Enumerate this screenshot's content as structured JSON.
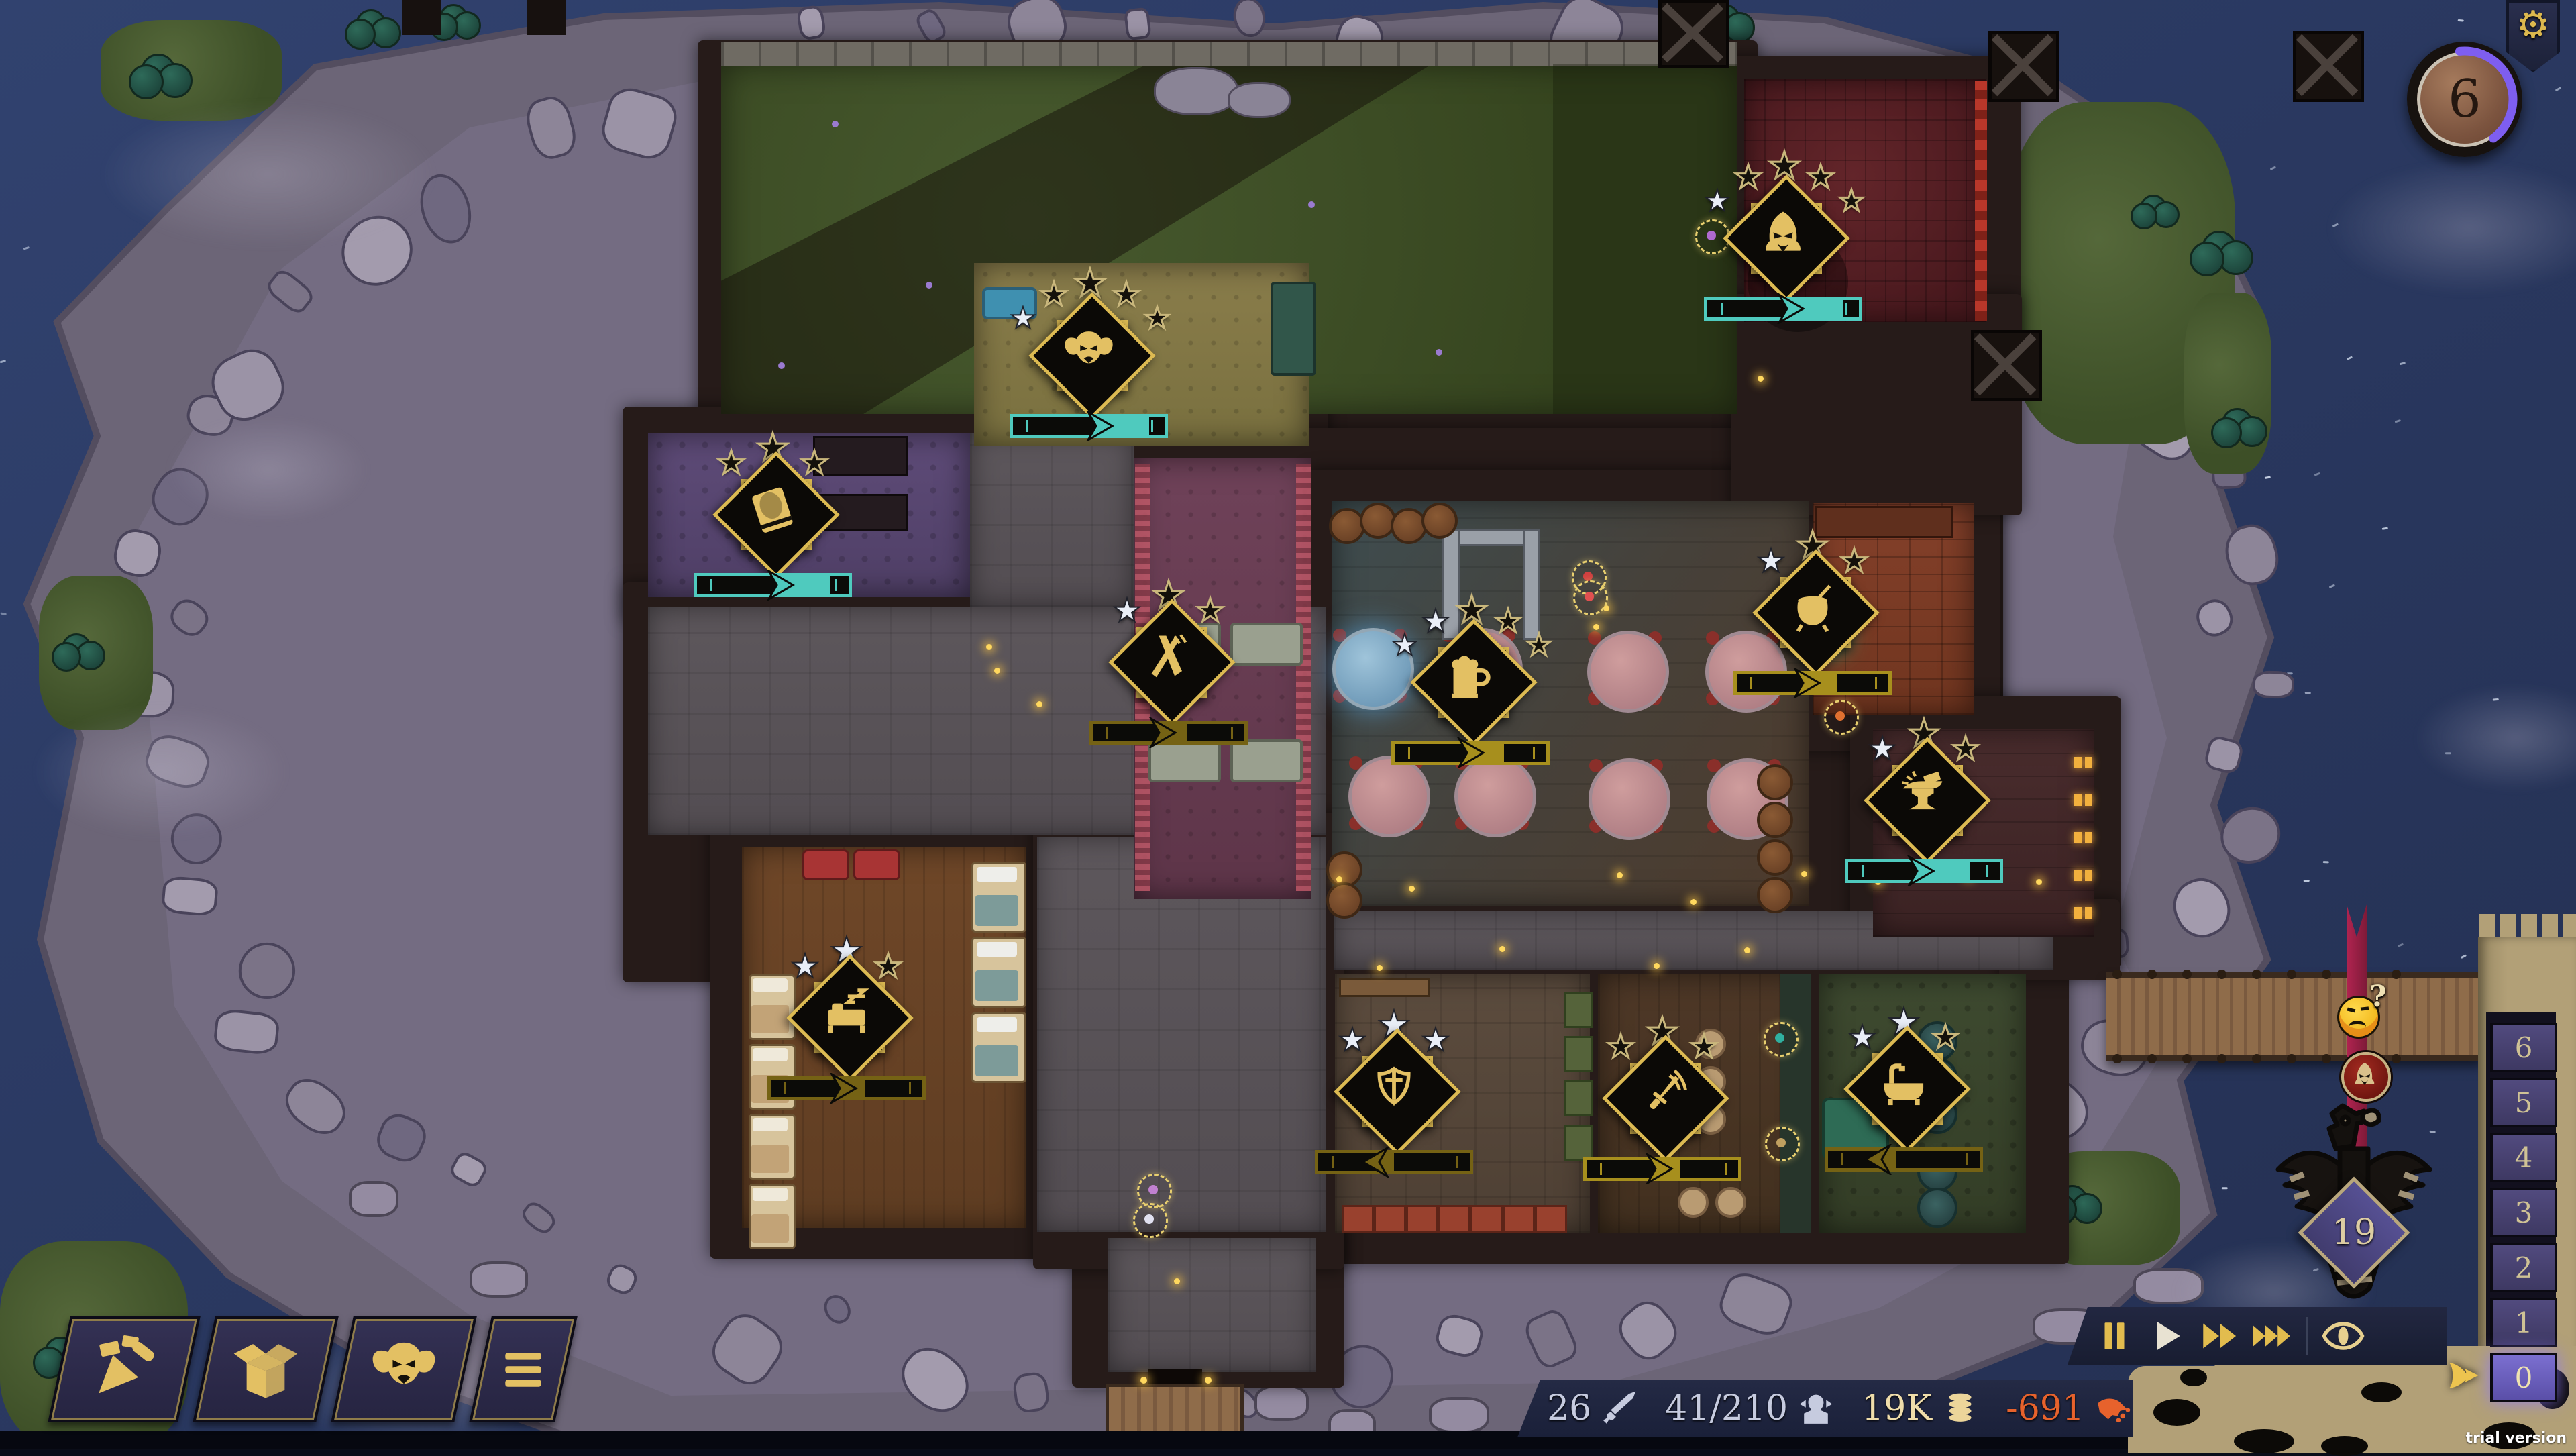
{
  "meta": {
    "trial_label": "trial version"
  },
  "top_right": {
    "settings_gear": "⚙",
    "clock_value": "6",
    "clock_progress_deg": 150
  },
  "toolbar": {
    "buttons": [
      {
        "id": "build",
        "icon": "trowel-icon"
      },
      {
        "id": "storage",
        "icon": "box-icon"
      },
      {
        "id": "staff",
        "icon": "goblin-icon"
      },
      {
        "id": "menu",
        "icon": "menu-icon"
      }
    ]
  },
  "speed_bar": {
    "buttons": [
      {
        "id": "pause",
        "icon": "pause-icon",
        "color": "#e2bc4e"
      },
      {
        "id": "play",
        "icon": "play-icon",
        "color": "#e8e2d2"
      },
      {
        "id": "speed2",
        "icon": "ff2-icon",
        "color": "#e2bc4e"
      },
      {
        "id": "speed3",
        "icon": "ff3-icon",
        "color": "#e2bc4e"
      },
      {
        "id": "overlay-eye",
        "icon": "eye-icon",
        "color": "#e6cf8e"
      }
    ]
  },
  "resources": [
    {
      "id": "defense",
      "value": "26",
      "icon": "sword-icon",
      "color": "#c6cbdf"
    },
    {
      "id": "guests",
      "value": "41/210",
      "icon": "goblin-bust-icon",
      "color": "#c6cbdf"
    },
    {
      "id": "gold",
      "value": "19K",
      "icon": "coins-icon",
      "color": "#efddaa"
    },
    {
      "id": "balance",
      "value": "-691",
      "icon": "hand-coins-icon",
      "color": "#e7622c"
    },
    {
      "id": "date",
      "value": "10-day period 9",
      "icon": "clock-icon",
      "icon2": "calendar-icon",
      "color": "#eadbb0"
    }
  ],
  "floor_selector": {
    "floors": [
      "6",
      "5",
      "4",
      "3",
      "2",
      "1",
      "0"
    ],
    "active_floor": "0"
  },
  "milestone": {
    "value": "19"
  },
  "visitor_banner": {
    "question_mark": "?"
  },
  "rooms": [
    {
      "id": "hideout",
      "icon": "hood-icon",
      "stars_total": 5,
      "stars_filled": 1,
      "bar": {
        "color": "teal",
        "arrow": 55,
        "fill_to": 90,
        "dir": "right"
      },
      "badge": [
        2658,
        330
      ],
      "rect": [
        2600,
        118,
        360,
        362
      ],
      "floor": "#5b2126"
    },
    {
      "id": "lounge",
      "icon": "goblin-icon",
      "stars_total": 5,
      "stars_filled": 1,
      "bar": {
        "color": "teal",
        "arrow": 57,
        "fill_to": 90,
        "dir": "right"
      },
      "badge": [
        1623,
        505
      ],
      "rect": [
        1452,
        392,
        500,
        272
      ],
      "floor": "#877a49"
    },
    {
      "id": "library",
      "icon": "book-icon",
      "stars_total": 3,
      "stars_filled": 0,
      "bar": {
        "color": "teal",
        "arrow": 55,
        "fill_to": 88,
        "dir": "right"
      },
      "badge": [
        1152,
        742
      ],
      "rect": [
        966,
        646,
        480,
        244
      ],
      "floor": "#5c4a76"
    },
    {
      "id": "dining-room",
      "icon": "fork-knife-icon",
      "stars_total": 3,
      "stars_filled": 1,
      "bar": {
        "color": "darkgold",
        "arrow": 46,
        "fill_to": 62,
        "dir": "right"
      },
      "badge": [
        1742,
        962
      ],
      "rect": [
        1690,
        682,
        265,
        658
      ],
      "floor": "#6d4159"
    },
    {
      "id": "tavern-hall",
      "icon": "mug-icon",
      "stars_total": 5,
      "stars_filled": 2,
      "bar": {
        "color": "gold",
        "arrow": 50,
        "fill_to": 72,
        "dir": "right"
      },
      "badge": [
        2192,
        992
      ],
      "rect": [
        1986,
        746,
        710,
        604
      ],
      "floor": "#45413c"
    },
    {
      "id": "kitchen",
      "icon": "cauldron-icon",
      "stars_total": 3,
      "stars_filled": 1,
      "bar": {
        "color": "gold",
        "arrow": 46,
        "fill_to": 66,
        "dir": "right"
      },
      "badge": [
        2702,
        888
      ],
      "rect": [
        2702,
        750,
        240,
        315
      ],
      "floor": "#7e3d26"
    },
    {
      "id": "workshop",
      "icon": "anvil-icon",
      "stars_total": 3,
      "stars_filled": 1,
      "bar": {
        "color": "teal",
        "arrow": 48,
        "fill_to": 80,
        "dir": "right"
      },
      "badge": [
        2868,
        1168
      ],
      "rect": [
        2792,
        1086,
        330,
        310
      ],
      "floor": "#452a2b"
    },
    {
      "id": "dormitory",
      "icon": "bed-icon",
      "stars_total": 3,
      "stars_filled": 2,
      "bar": {
        "color": "darkgold",
        "arrow": 48,
        "fill_to": 62,
        "dir": "right"
      },
      "badge": [
        1262,
        1492
      ],
      "rect": [
        1106,
        1262,
        424,
        568
      ],
      "floor": "#6c4527"
    },
    {
      "id": "guard-room",
      "icon": "sword-shield-icon",
      "stars_total": 3,
      "stars_filled": 3,
      "bar": {
        "color": "darkgold",
        "arrow": 38,
        "fill_to": 50,
        "dir": "left"
      },
      "badge": [
        2078,
        1602
      ],
      "rect": [
        1990,
        1452,
        380,
        386
      ],
      "floor": "#59493c"
    },
    {
      "id": "training-room",
      "icon": "dagger-icon",
      "stars_total": 3,
      "stars_filled": 0,
      "bar": {
        "color": "gold",
        "arrow": 48,
        "fill_to": 62,
        "dir": "right"
      },
      "badge": [
        2478,
        1612
      ],
      "rect": [
        2382,
        1452,
        318,
        386
      ],
      "floor": "#4b3627"
    },
    {
      "id": "bathhouse",
      "icon": "bathtub-icon",
      "stars_total": 3,
      "stars_filled": 2,
      "bar": {
        "color": "darkgold",
        "arrow": 33,
        "fill_to": 45,
        "dir": "left"
      },
      "badge": [
        2838,
        1598
      ],
      "rect": [
        2712,
        1452,
        308,
        386
      ],
      "floor": "#3a452d"
    }
  ]
}
